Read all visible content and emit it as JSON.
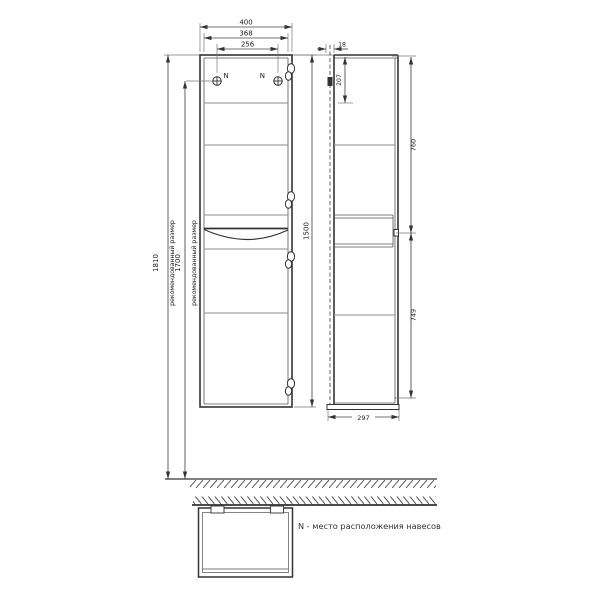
{
  "front_view": {
    "dim_width_outer": "400",
    "dim_width_inner": "368",
    "dim_hanger_spacing": "256",
    "dim_cabinet_height": "1500",
    "dim_overall_height": "1810",
    "dim_hanger_height": "1700",
    "recommended_label_1": "рекомендованный размер",
    "recommended_label_2": "рекомендованный размер",
    "hanger_mark": "N"
  },
  "side_view": {
    "dim_wall_offset": "18",
    "dim_hanger_offset": "207",
    "dim_upper_section": "760",
    "dim_lower_section": "749",
    "dim_depth": "297"
  },
  "top_view": {
    "note": "N - место расположения навесов"
  }
}
